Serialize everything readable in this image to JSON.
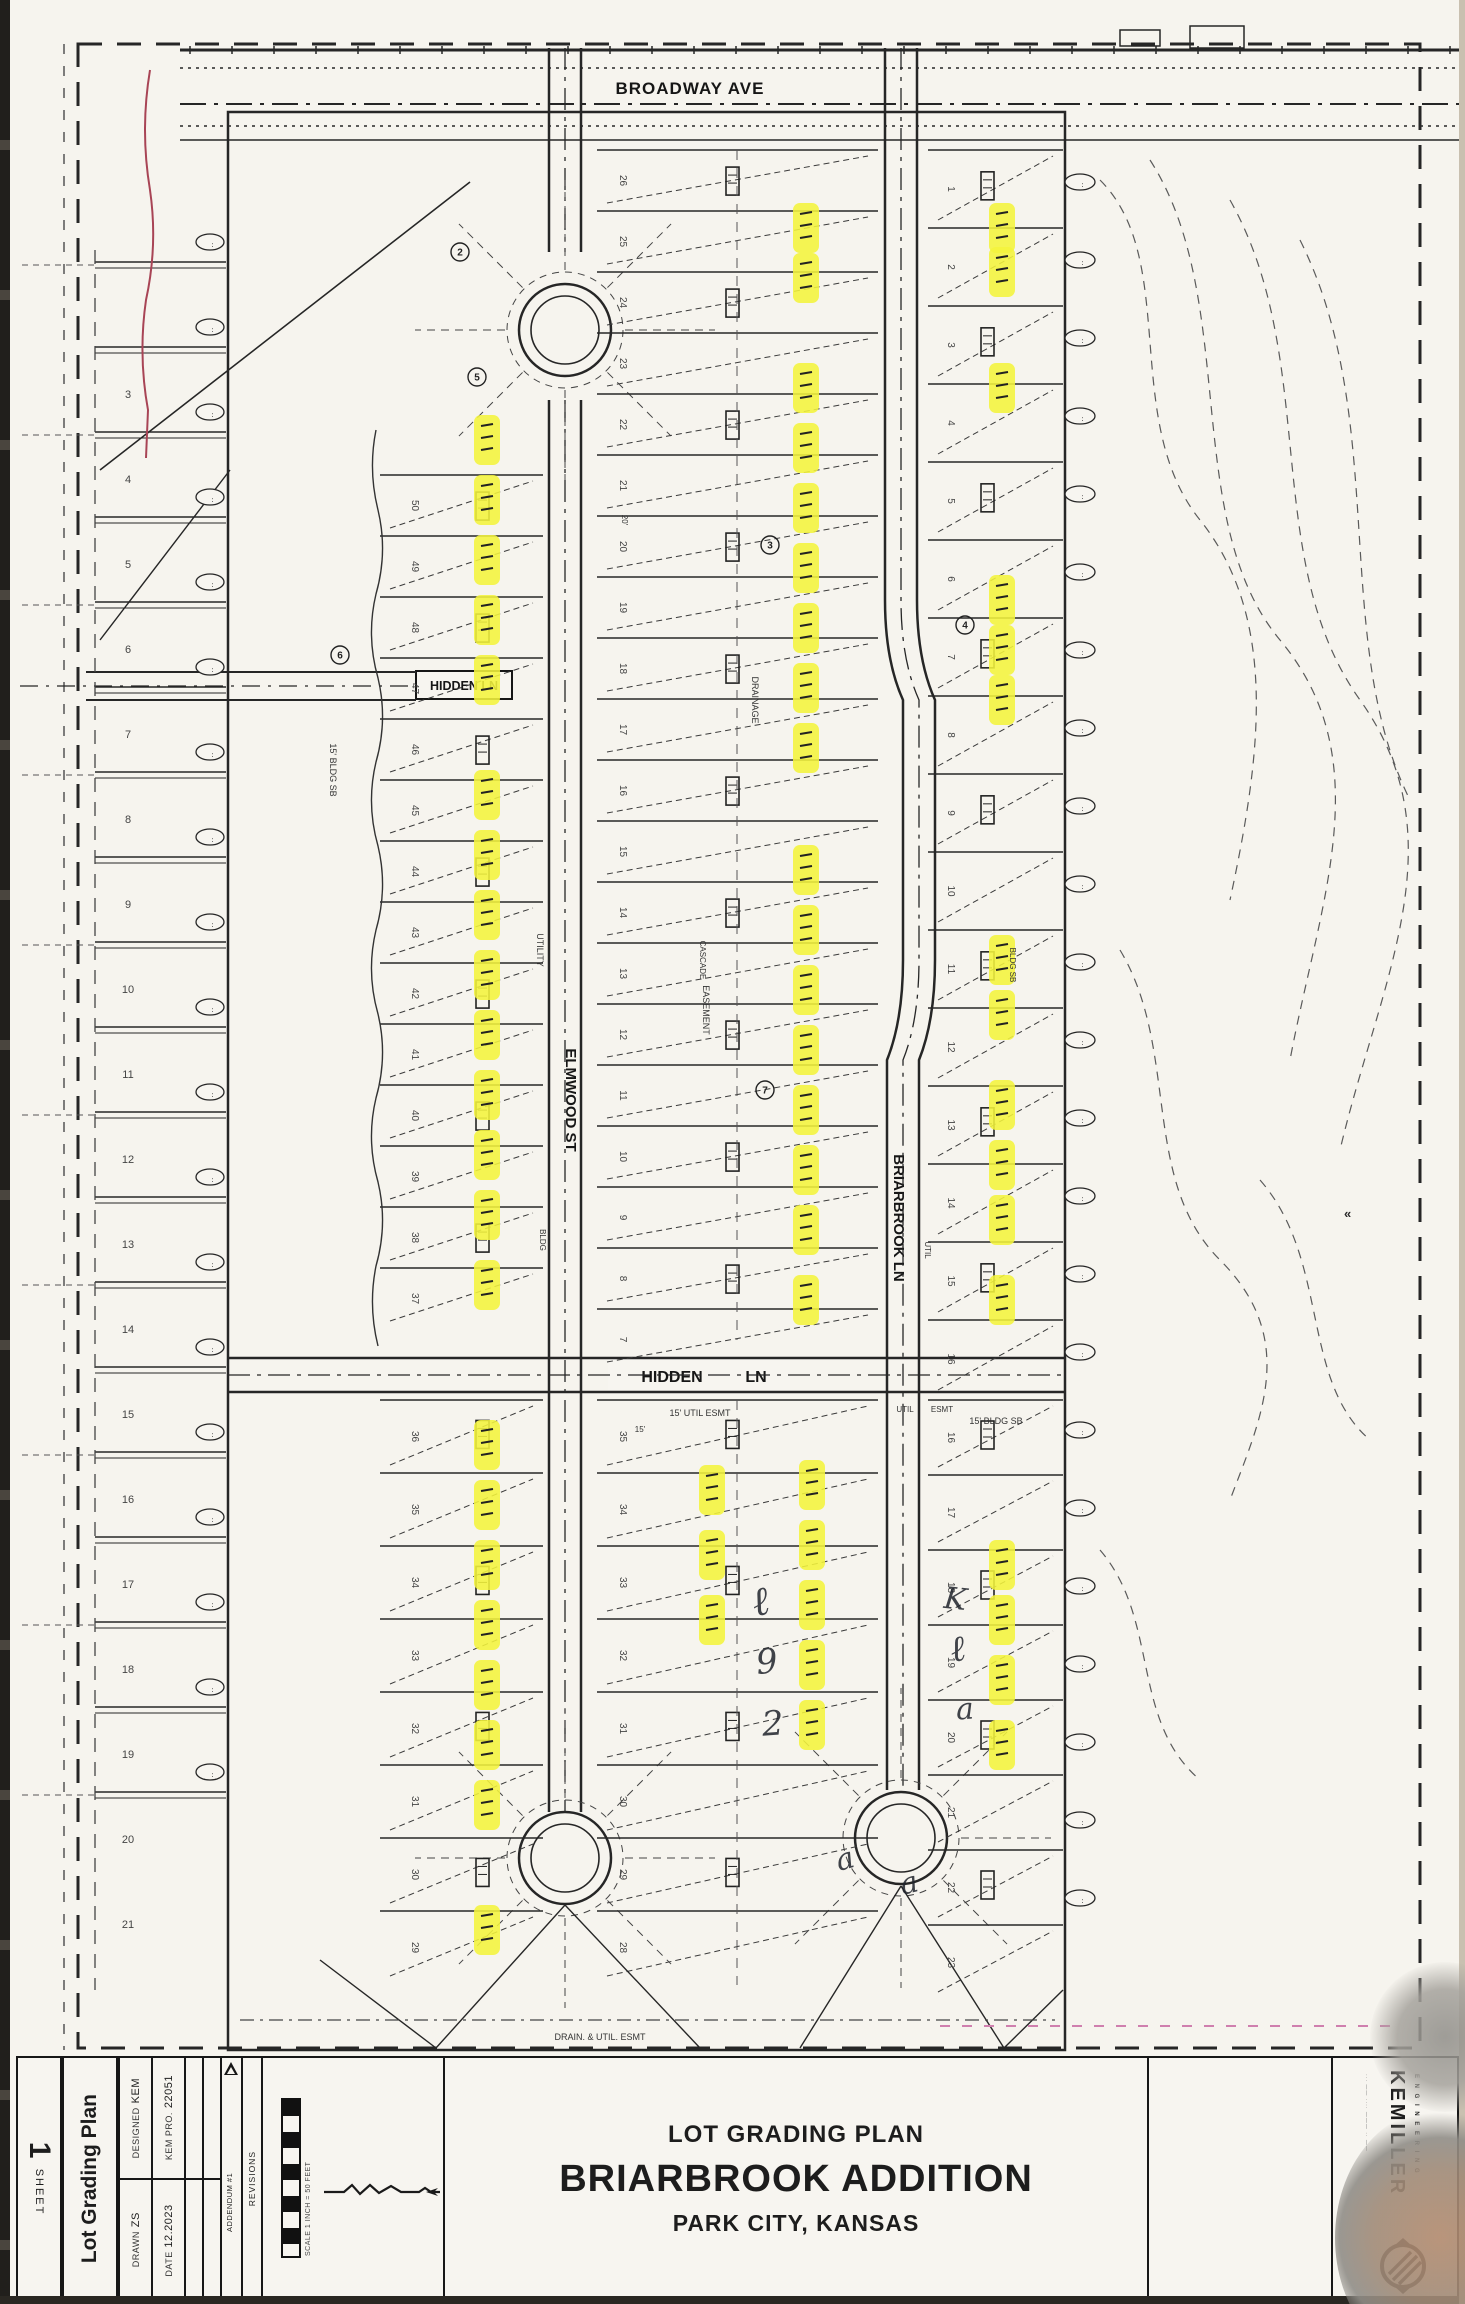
{
  "document": {
    "type_label": "LOT GRADING PLAN",
    "title": "BRIARBROOK ADDITION",
    "location": "PARK CITY, KANSAS"
  },
  "sheet": {
    "label": "SHEET",
    "number": "1",
    "sidebar_title": "Lot Grading Plan"
  },
  "title_block": {
    "designed_label": "DESIGNED",
    "designed_value": "KEM",
    "drawn_label": "DRAWN",
    "drawn_value": "ZS",
    "project_label": "KEM PRO.",
    "project_value": "22051",
    "date_label": "DATE",
    "date_value": "12.2023",
    "revisions_header": "REVISIONS",
    "revision_entry": "ADDENDUM #1",
    "revision_date": "04.17.2024",
    "scale_note": "SCALE 1 INCH = 50 FEET"
  },
  "firm": {
    "name": "KEMILLER",
    "tagline": "E N G I N E E R I N G"
  },
  "streets": {
    "broadway": "BROADWAY AVE",
    "elmwood": "ELMWOOD ST",
    "briarbrook": "BRIARBROOK LN",
    "hidden_left": "HIDDEN LN",
    "hidden_mid_a": "HIDDEN",
    "hidden_mid_b": "LN"
  },
  "left_lot_numbers": [
    "3",
    "4",
    "5",
    "6",
    "7",
    "8",
    "9",
    "10",
    "11",
    "12",
    "13",
    "14",
    "15",
    "16",
    "17",
    "18",
    "19",
    "20",
    "21"
  ],
  "lot_numbers": {
    "col_a_top": [
      "50",
      "49",
      "48",
      "47",
      "46",
      "45",
      "44",
      "43",
      "42",
      "41",
      "40",
      "39",
      "38",
      "37"
    ],
    "col_a_bottom": [
      "36",
      "35",
      "34",
      "33",
      "32",
      "31",
      "30",
      "29"
    ],
    "col_b_top": [
      "26",
      "25",
      "24",
      "23",
      "22",
      "21",
      "20",
      "19",
      "18",
      "17",
      "16",
      "15",
      "14",
      "13",
      "12",
      "11",
      "10",
      "9",
      "8",
      "7"
    ],
    "col_b_bottom": [
      "35",
      "34",
      "33",
      "32",
      "31",
      "30",
      "29",
      "28"
    ],
    "col_c_top": [
      "1",
      "2",
      "3",
      "4",
      "5",
      "6",
      "7",
      "8",
      "9",
      "10",
      "11",
      "12",
      "13",
      "14",
      "15",
      "16"
    ],
    "col_c_bottom": [
      "16",
      "17",
      "18",
      "19",
      "20",
      "21",
      "22",
      "23"
    ]
  },
  "misc_labels": [
    {
      "text": "15' UTIL ESMT",
      "x": 700,
      "y": 1416,
      "s": 9,
      "r": 0
    },
    {
      "text": "15' BLDG SB",
      "x": 996,
      "y": 1424,
      "s": 9,
      "r": 0
    },
    {
      "text": "15' BLDG SB",
      "x": 330,
      "y": 770,
      "s": 9,
      "r": 90
    },
    {
      "text": "DRAINAGE",
      "x": 752,
      "y": 700,
      "s": 9,
      "r": 90
    },
    {
      "text": "UTILITY",
      "x": 537,
      "y": 950,
      "s": 9,
      "r": 90
    },
    {
      "text": "EASEMENT",
      "x": 703,
      "y": 1010,
      "s": 9,
      "r": 90
    },
    {
      "text": "CASCADE",
      "x": 700,
      "y": 960,
      "s": 8,
      "r": 90
    },
    {
      "text": "BLDG",
      "x": 540,
      "y": 1240,
      "s": 8,
      "r": 90
    },
    {
      "text": "20'",
      "x": 622,
      "y": 520,
      "s": 8,
      "r": 90
    },
    {
      "text": "UTIL",
      "x": 905,
      "y": 1412,
      "s": 8,
      "r": 0
    },
    {
      "text": "ESMT",
      "x": 942,
      "y": 1412,
      "s": 8,
      "r": 0
    },
    {
      "text": "DRAIN. & UTIL. ESMT",
      "x": 600,
      "y": 2040,
      "s": 9,
      "r": 0
    },
    {
      "text": "15'",
      "x": 640,
      "y": 1432,
      "s": 8,
      "r": 0
    },
    {
      "text": "BLDG SB",
      "x": 1010,
      "y": 965,
      "s": 8,
      "r": 90
    },
    {
      "text": "UTIL",
      "x": 925,
      "y": 1250,
      "s": 8,
      "r": 90
    }
  ],
  "circled_numbers": [
    {
      "n": "2",
      "x": 460,
      "y": 252
    },
    {
      "n": "5",
      "x": 477,
      "y": 377
    },
    {
      "n": "3",
      "x": 770,
      "y": 545
    },
    {
      "n": "4",
      "x": 965,
      "y": 625
    },
    {
      "n": "6",
      "x": 340,
      "y": 655
    },
    {
      "n": "7",
      "x": 765,
      "y": 1090
    }
  ],
  "highlights": {
    "col_a_x": 487,
    "col_a_y": [
      440,
      500,
      560,
      620,
      680,
      795,
      855,
      915,
      975,
      1035,
      1095,
      1155,
      1215,
      1285
    ],
    "col_a2_x": 487,
    "col_a2_y": [
      1445,
      1505,
      1565,
      1625,
      1685,
      1745,
      1805,
      1930
    ],
    "col_b_x": 806,
    "col_b_y": [
      228,
      278,
      388,
      448,
      508,
      568,
      628,
      688,
      748,
      870,
      930,
      990,
      1050,
      1110,
      1170,
      1230,
      1300
    ],
    "col_b2_x": 812,
    "col_b2_y": [
      1485,
      1545,
      1605,
      1665,
      1725
    ],
    "col_b3_x": 712,
    "col_b3_y": [
      1490,
      1555,
      1620
    ],
    "col_c_x": 1002,
    "col_c_y": [
      228,
      272,
      388,
      600,
      650,
      700,
      960,
      1015,
      1105,
      1165,
      1220,
      1300,
      1565,
      1620,
      1680,
      1745
    ]
  },
  "pen_marks": [
    {
      "glyph": "ℓ",
      "x": 752,
      "y": 1618,
      "size": 40,
      "rot": -12
    },
    {
      "glyph": "9",
      "x": 756,
      "y": 1676,
      "size": 34,
      "rot": -6
    },
    {
      "glyph": "2",
      "x": 762,
      "y": 1738,
      "size": 34,
      "rot": -4
    },
    {
      "glyph": "K",
      "x": 944,
      "y": 1612,
      "size": 30,
      "rot": 6
    },
    {
      "glyph": "ℓ",
      "x": 950,
      "y": 1664,
      "size": 36,
      "rot": -10
    },
    {
      "glyph": "a",
      "x": 956,
      "y": 1722,
      "size": 30,
      "rot": -4
    },
    {
      "glyph": "a",
      "x": 836,
      "y": 1872,
      "size": 30,
      "rot": -16
    },
    {
      "glyph": "a",
      "x": 900,
      "y": 1896,
      "size": 30,
      "rot": -14
    }
  ],
  "colors": {
    "paper": "#f6f4ee",
    "ink": "#1d1d1d",
    "highlight": "#f4f43c",
    "red_line": "#a84455",
    "magenta": "#cf7fae"
  }
}
